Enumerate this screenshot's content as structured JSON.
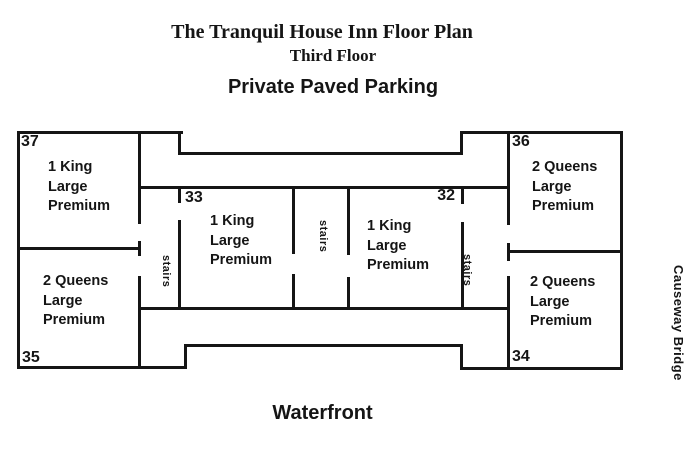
{
  "titles": {
    "main": "The Tranquil House Inn Floor Plan",
    "subtitle": "Third Floor",
    "parking": "Private Paved Parking",
    "waterfront": "Waterfront",
    "causeway": "Causeway Bridge"
  },
  "labels": {
    "stairs": "stairs"
  },
  "rooms": {
    "r37": {
      "number": "37",
      "lines": [
        "1 King",
        "Large",
        "Premium"
      ]
    },
    "r33": {
      "number": "33",
      "lines": [
        "1 King",
        "Large",
        "Premium"
      ]
    },
    "r32": {
      "number": "32",
      "lines": [
        "1 King",
        "Large",
        "Premium"
      ]
    },
    "r36": {
      "number": "36",
      "lines": [
        "2 Queens",
        "Large",
        "Premium"
      ]
    },
    "r35": {
      "number": "35",
      "lines": [
        "2 Queens",
        "Large",
        "Premium"
      ]
    },
    "r34": {
      "number": "34",
      "lines": [
        "2 Queens",
        "Large",
        "Premium"
      ]
    }
  },
  "colors": {
    "background": "#ffffff",
    "line": "#151515",
    "text": "#151515"
  }
}
